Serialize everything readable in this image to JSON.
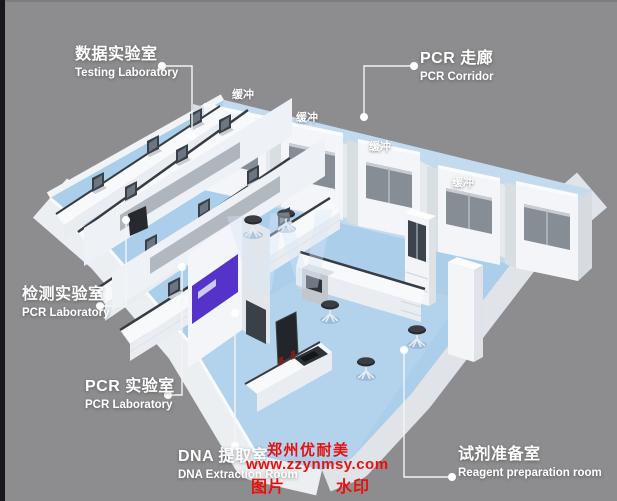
{
  "scene": {
    "description": "3D isometric rendering of a PCR laboratory suite floor plan"
  },
  "room_labels": [
    {
      "id": "testing",
      "zh": "数据实验室",
      "en": "Testing Laboratory"
    },
    {
      "id": "pcr-corridor",
      "zh": "PCR 走廊",
      "en": "PCR Corridor"
    },
    {
      "id": "detection",
      "zh": "检测实验室",
      "en": "PCR Laboratory"
    },
    {
      "id": "pcr-lab",
      "zh": "PCR 实验室",
      "en": "PCR Laboratory"
    },
    {
      "id": "dna-extraction",
      "zh": "DNA 提取室",
      "en": "DNA Extraction Room"
    },
    {
      "id": "reagent-prep",
      "zh": "试剂准备室",
      "en": "Reagent preparation room"
    }
  ],
  "buffer_label": "缓冲",
  "watermark": {
    "brand": "郑州优耐美",
    "url": "www.zzynmsy.com",
    "tag_left": "图片",
    "tag_right": "水印"
  },
  "colors": {
    "background": "#8d8d8f",
    "floor_blue": "#abceea",
    "corridor_blue": "#c7dcf0",
    "wall_white": "#f2f4f7",
    "window_gray": "#878d95",
    "accent_purple": "#5532c8",
    "stool_dark": "#2b2d30",
    "watermark_red": "#e8100e",
    "label_white": "#ffffff",
    "edge_strip_dark": "#17171d"
  }
}
